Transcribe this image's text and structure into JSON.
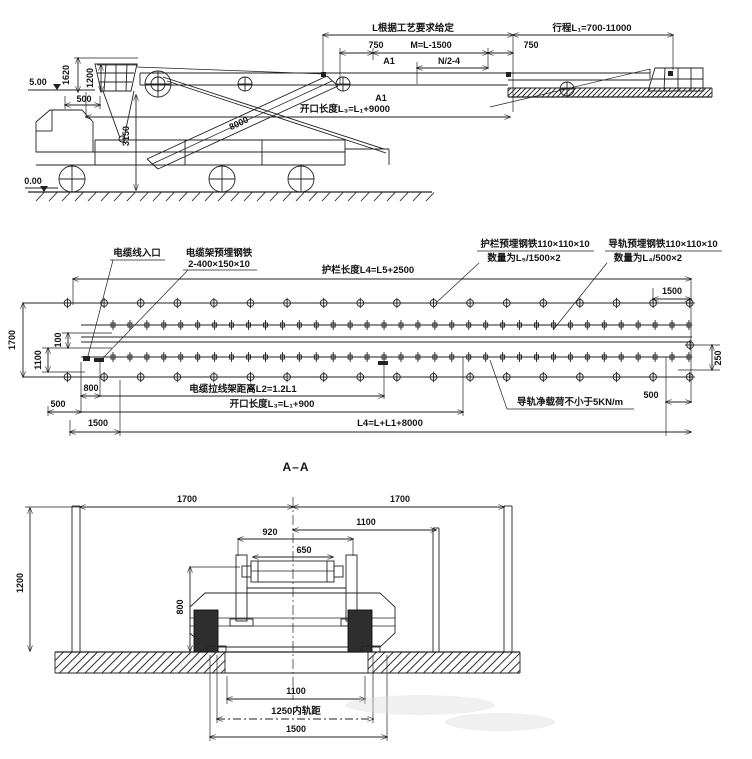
{
  "drawing": {
    "type": "engineering-drawing",
    "ink_color": "#212121",
    "background": "#ffffff"
  },
  "elevation": {
    "labels": {
      "given_length": "L根据工艺要求给定",
      "travel": "行程L₁=700-11000",
      "left_750": "750",
      "m_eq": "M=L-1500",
      "right_750": "750",
      "a1_upper": "A1",
      "n_eq": "N/2-4",
      "a1_lower": "A1",
      "opening": "开口长度L₃=L₁+9000",
      "h_1620": "1620",
      "h_1200": "1200",
      "w_500": "500",
      "h_3150": "3150",
      "boom_8000": "8000",
      "level_top": "5.00",
      "level_ground": "0.00"
    }
  },
  "plan": {
    "labels": {
      "cable_entry": "电缆线入口",
      "cable_rack_1": "电缆架预埋钢铁",
      "cable_rack_2": "2-400×150×10",
      "guard_length": "护栏长度L4=L5+2500",
      "guard_embed_1": "护栏预埋钢铁110×110×10",
      "guard_embed_2": "数量为L₅/1500×2",
      "rail_embed_1": "导轨预埋钢铁110×110×10",
      "rail_embed_2": "数量为L₄/500×2",
      "right_1500": "1500",
      "v_1700": "1700",
      "v_1100": "1100",
      "v_100": "100",
      "b_800": "800",
      "b_500": "500",
      "b_1500": "1500",
      "cable_stay": "电缆拉线架距离L2=1.2L1",
      "opening": "开口长度L₃=L₁+900",
      "l4_eq": "L4=L+L1+8000",
      "rail_load": "导轨净载荷不小于5KN/m",
      "r_500": "500",
      "r_250": "250"
    }
  },
  "section": {
    "labels": {
      "title": "A–A",
      "left_1700": "1700",
      "right_1700": "1700",
      "t_1100": "1100",
      "t_920": "920",
      "t_650": "650",
      "h_800": "800",
      "h_1200": "1200",
      "b_1100": "1100",
      "gauge": "1250内轨距",
      "b_1500": "1500"
    }
  }
}
